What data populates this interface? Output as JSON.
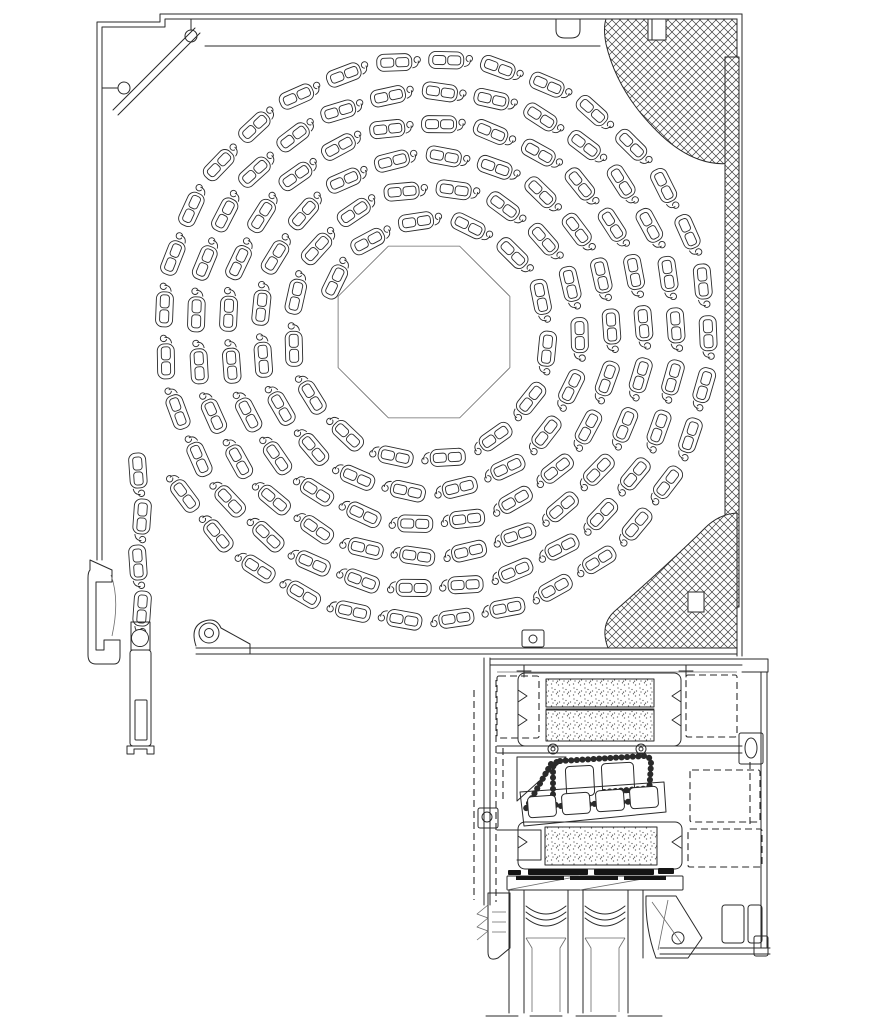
{
  "meta": {
    "drawing_type": "technical-cross-section",
    "subject": "roller-shutter-box-with-coiled-curtain-and-window-frame-profile",
    "visible_text": []
  },
  "colors": {
    "background": "#ffffff",
    "line": "#2a2a2a",
    "line_light": "#6a6a6a",
    "dark": "#151515",
    "hatch": "#3a3a3a",
    "stipple": "#5a5a5a"
  },
  "patterns": {
    "crosshatch": {
      "size": 8,
      "stroke_width": 0.65,
      "paths": [
        "M0,8 L8,0",
        "M0,0 L8,8",
        "M-2,2 L2,-2",
        "M6,10 L10,6",
        "M-2,6 L2,10",
        "M6,-2 L10,2"
      ]
    },
    "stipple": {
      "size": 11,
      "dot_r": 0.65,
      "dots": [
        [
          1.5,
          2
        ],
        [
          5,
          7.5
        ],
        [
          8.5,
          3
        ],
        [
          3,
          10
        ],
        [
          9.5,
          9
        ],
        [
          6.5,
          0.8
        ],
        [
          2,
          6
        ],
        [
          7.5,
          10.2
        ]
      ]
    }
  },
  "layers": [
    {
      "name": "shutter-box",
      "shapes": [
        {
          "t": "p",
          "cls": "ln",
          "d": "M742,14 H160 V22 H97 V560"
        },
        {
          "t": "p",
          "cls": "ln",
          "d": "M737,19 H165 V27 H102 V560"
        },
        {
          "t": "p",
          "cls": "ln",
          "d": "M742,14 V656"
        },
        {
          "t": "p",
          "cls": "ln",
          "d": "M737,19 V656"
        },
        {
          "t": "l",
          "cls": "ln",
          "x1": 196,
          "y1": 648,
          "x2": 737,
          "y2": 648
        },
        {
          "t": "l",
          "cls": "ln",
          "x1": 196,
          "y1": 654,
          "x2": 737,
          "y2": 654
        },
        {
          "t": "p",
          "cls": "ln",
          "d": "M205,46 H600"
        },
        {
          "t": "p",
          "cls": "ln",
          "d": "M113,110 L195,28"
        },
        {
          "t": "p",
          "cls": "ln",
          "d": "M118,115 L200,33"
        },
        {
          "t": "c",
          "cls": "ln",
          "cx": 191,
          "cy": 36,
          "r": 6
        },
        {
          "t": "p",
          "cls": "ln",
          "d": "M191,30 V19"
        },
        {
          "t": "c",
          "cls": "ln",
          "cx": 124,
          "cy": 88,
          "r": 6
        },
        {
          "t": "p",
          "cls": "ln",
          "d": "M118,88 H102"
        },
        {
          "t": "p",
          "cls": "ln",
          "d": "M652,19 V42 H668 V19"
        },
        {
          "t": "p",
          "cls": "ln",
          "d": "M686,19 V56 M691,19 V56"
        },
        {
          "t": "r",
          "cls": "ln",
          "x": 678,
          "y": 56,
          "w": 22,
          "h": 9,
          "rx": 0
        },
        {
          "t": "c",
          "cls": "ln",
          "cx": 712,
          "cy": 41,
          "r": 5
        },
        {
          "t": "c",
          "cls": "ln",
          "cx": 726,
          "cy": 45,
          "r": 4
        },
        {
          "t": "p",
          "cls": "ln",
          "d": "M556,19 v11 q0,8 9,8 h6 q9,0 9,-8 v-11"
        },
        {
          "t": "r",
          "cls": "ln",
          "x": 522,
          "y": 630,
          "w": 22,
          "h": 17,
          "rx": 2
        },
        {
          "t": "c",
          "cls": "ln",
          "cx": 533,
          "cy": 639,
          "r": 4
        },
        {
          "t": "r",
          "cls": "ln",
          "x": 634,
          "y": 630,
          "w": 26,
          "h": 17,
          "rx": 2
        },
        {
          "t": "c",
          "cls": "ln",
          "cx": 647,
          "cy": 639,
          "r": 4
        },
        {
          "t": "p",
          "cls": "ln",
          "d": "M196,646 Q190,628 202,622 Q216,616 221,628 L250,644 V654"
        },
        {
          "t": "c",
          "cls": "ln",
          "cx": 209,
          "cy": 633,
          "r": 10
        },
        {
          "t": "c",
          "cls": "ln",
          "cx": 209,
          "cy": 633,
          "r": 4.5
        }
      ]
    },
    {
      "name": "insulation-blocks",
      "shapes": [
        {
          "t": "hp",
          "d": "M606,19 H648 V40 H666 V19 H737 V162 C712,168 686,158 662,136 C630,106 613,74 606,44 Q603,28 606,19 Z"
        },
        {
          "t": "hp",
          "d": "M725,57 H739 V607 H725 Z"
        },
        {
          "t": "hp",
          "d": "M608,648 Q599,624 616,610 C648,582 686,547 705,528 Q719,514 737,513 L737,648 Z"
        },
        {
          "t": "r",
          "cls": "wn",
          "x": 688,
          "y": 592,
          "w": 16,
          "h": 20,
          "rx": 0
        }
      ]
    },
    {
      "name": "octagonal-shaft",
      "shapes": [
        {
          "t": "oct",
          "cx": 424,
          "cy": 332,
          "r": 93,
          "cls": "thin"
        }
      ]
    },
    {
      "name": "slat-coil",
      "shapes": [
        {
          "t": "coil",
          "cx": 428,
          "cy": 332,
          "rIn": 106,
          "rOut": 294,
          "turns": 5.85,
          "pitch": 52,
          "endDeg": 155
        }
      ]
    },
    {
      "name": "curtain-exit",
      "shapes": [
        {
          "t": "curt",
          "x": 140,
          "yTop": 472,
          "pitch": 46,
          "count": 4
        },
        {
          "t": "p",
          "cls": "ln",
          "d": "M90,560 V570 Q88,572 88,578 V655 Q88,664 96,664 H114 Q120,664 120,656 V640 H104 V650 H96 V582 H112 V570 Z"
        },
        {
          "t": "p",
          "cls": "thin",
          "d": "M111,575 Q120,600 112,636"
        },
        {
          "t": "p",
          "cls": "ln",
          "d": "M131,622 H150 V650 H131 Z"
        },
        {
          "t": "c",
          "cls": "sl",
          "cx": 140,
          "cy": 638,
          "r": 8.5
        },
        {
          "t": "r",
          "cls": "ln",
          "x": 130,
          "y": 650,
          "w": 21,
          "h": 96,
          "rx": 3
        },
        {
          "t": "r",
          "cls": "ln",
          "x": 135,
          "y": 700,
          "w": 12,
          "h": 40,
          "rx": 1
        },
        {
          "t": "p",
          "cls": "ln",
          "d": "M127,746 h27 M127,746 v8 h7 v-5 h13 v5 h7 v-8"
        }
      ]
    },
    {
      "name": "frame-section",
      "shapes": [
        {
          "t": "l",
          "cls": "ln",
          "x1": 490,
          "y1": 659,
          "x2": 742,
          "y2": 659
        },
        {
          "t": "l",
          "cls": "ln",
          "x1": 490,
          "y1": 665,
          "x2": 742,
          "y2": 665
        },
        {
          "t": "l",
          "cls": "thin",
          "x1": 497,
          "y1": 672,
          "x2": 737,
          "y2": 672
        },
        {
          "t": "l",
          "cls": "ln",
          "x1": 484,
          "y1": 658,
          "x2": 484,
          "y2": 905
        },
        {
          "t": "l",
          "cls": "ln",
          "x1": 490,
          "y1": 658,
          "x2": 490,
          "y2": 905
        },
        {
          "t": "r",
          "cls": "dash",
          "x": 497,
          "y": 676,
          "w": 42,
          "h": 62,
          "rx": 2
        },
        {
          "t": "r",
          "cls": "dash",
          "x": 686,
          "y": 675,
          "w": 51,
          "h": 62,
          "rx": 2
        },
        {
          "t": "r",
          "cls": "ln",
          "x": 518,
          "y": 673,
          "w": 163,
          "h": 73,
          "rx": 7
        },
        {
          "t": "p",
          "cls": "ln",
          "d": "M518,690 l9,6 -9,6 M518,714 l9,6 -9,6"
        },
        {
          "t": "p",
          "cls": "ln",
          "d": "M681,690 l-9,6 9,6 M681,714 l-9,6 9,6"
        },
        {
          "t": "sr",
          "x": 546,
          "y": 679,
          "w": 108,
          "h": 28
        },
        {
          "t": "sr",
          "x": 546,
          "y": 710,
          "w": 108,
          "h": 31
        },
        {
          "t": "l",
          "cls": "ln",
          "x1": 546,
          "y1": 709,
          "x2": 654,
          "y2": 709
        },
        {
          "t": "l",
          "cls": "ln",
          "x1": 497,
          "y1": 746,
          "x2": 742,
          "y2": 746
        },
        {
          "t": "l",
          "cls": "ln",
          "x1": 497,
          "y1": 753,
          "x2": 742,
          "y2": 753
        },
        {
          "t": "c",
          "cls": "ln",
          "cx": 553,
          "cy": 749,
          "r": 5
        },
        {
          "t": "c",
          "cls": "ln",
          "cx": 553,
          "cy": 749,
          "r": 2
        },
        {
          "t": "c",
          "cls": "ln",
          "cx": 641,
          "cy": 749,
          "r": 5
        },
        {
          "t": "c",
          "cls": "ln",
          "cx": 641,
          "cy": 749,
          "r": 2
        },
        {
          "t": "r",
          "cls": "ln",
          "x": 739,
          "y": 733,
          "w": 24,
          "h": 31,
          "rx": 2
        },
        {
          "t": "e",
          "cls": "ln",
          "cx": 751,
          "cy": 748,
          "rx": 6,
          "ry": 10
        },
        {
          "t": "p",
          "cls": "ln",
          "d": "M742,659 H768 V672 H742"
        },
        {
          "t": "l",
          "cls": "ln",
          "x1": 761,
          "y1": 672,
          "x2": 761,
          "y2": 948
        },
        {
          "t": "l",
          "cls": "ln",
          "x1": 767,
          "y1": 672,
          "x2": 767,
          "y2": 948
        },
        {
          "t": "p",
          "cls": "ln",
          "d": "M517,757 L566,757 L517,801 Z"
        },
        {
          "t": "p",
          "cls": "dots",
          "d": "M560,761 L644,756 Q651,756 651,764 L649,794 Q649,801 641,801 L560,806 Q553,806 553,798 L553,769 Q553,762 560,761 Z"
        },
        {
          "t": "r",
          "cls": "wn",
          "x": 566,
          "y": 766,
          "w": 28,
          "h": 30,
          "rx": 4,
          "rot": -3
        },
        {
          "t": "r",
          "cls": "wn",
          "x": 602,
          "y": 763,
          "w": 32,
          "h": 30,
          "rx": 4,
          "rot": -3
        },
        {
          "t": "p",
          "cls": "dots",
          "d": "M604,792 L652,788"
        },
        {
          "t": "p",
          "cls": "dots",
          "d": "M551,764 L524,812"
        },
        {
          "t": "p",
          "cls": "ln",
          "d": "M520,792 L664,782 L666,812 L524,826 Z"
        },
        {
          "t": "r",
          "cls": "wn",
          "x": 528,
          "y": 796,
          "w": 28,
          "h": 21,
          "rx": 4,
          "rot": -4
        },
        {
          "t": "r",
          "cls": "wn",
          "x": 562,
          "y": 793,
          "w": 28,
          "h": 21,
          "rx": 4,
          "rot": -4
        },
        {
          "t": "r",
          "cls": "wn",
          "x": 596,
          "y": 790,
          "w": 28,
          "h": 21,
          "rx": 4,
          "rot": -4
        },
        {
          "t": "r",
          "cls": "wn",
          "x": 630,
          "y": 787,
          "w": 28,
          "h": 21,
          "rx": 4,
          "rot": -4
        },
        {
          "t": "r",
          "cls": "ln",
          "x": 518,
          "y": 822,
          "w": 164,
          "h": 47,
          "rx": 7
        },
        {
          "t": "p",
          "cls": "ln",
          "d": "M518,836 l9,6 -9,6 M681,836 l-9,6 9,6"
        },
        {
          "t": "sr",
          "x": 545,
          "y": 827,
          "w": 112,
          "h": 38
        },
        {
          "t": "r",
          "cls": "dash",
          "x": 688,
          "y": 829,
          "w": 74,
          "h": 38,
          "rx": 2
        },
        {
          "t": "r",
          "cls": "gk",
          "x": 528,
          "y": 869,
          "w": 60,
          "h": 6,
          "rx": 1
        },
        {
          "t": "r",
          "cls": "gk",
          "x": 594,
          "y": 869,
          "w": 60,
          "h": 6,
          "rx": 1
        },
        {
          "t": "r",
          "cls": "gk",
          "x": 508,
          "y": 870,
          "w": 13,
          "h": 5,
          "rx": 1
        },
        {
          "t": "r",
          "cls": "gk",
          "x": 658,
          "y": 868,
          "w": 16,
          "h": 6,
          "rx": 1
        },
        {
          "t": "r",
          "cls": "ln",
          "x": 507,
          "y": 876,
          "w": 176,
          "h": 14,
          "rx": 1
        },
        {
          "t": "l",
          "cls": "thin",
          "x1": 507,
          "y1": 890,
          "x2": 580,
          "y2": 876
        },
        {
          "t": "l",
          "cls": "thin",
          "x1": 580,
          "y1": 890,
          "x2": 660,
          "y2": 876
        },
        {
          "t": "r",
          "cls": "gk",
          "x": 516,
          "y": 876,
          "w": 48,
          "h": 4,
          "rx": 0
        },
        {
          "t": "r",
          "cls": "gk",
          "x": 570,
          "y": 876,
          "w": 48,
          "h": 4,
          "rx": 0
        },
        {
          "t": "r",
          "cls": "gk",
          "x": 624,
          "y": 876,
          "w": 42,
          "h": 4,
          "rx": 0
        },
        {
          "t": "p",
          "cls": "ln",
          "d": "M526,906 Q546,922 566,906 M526,912 Q546,928 566,912 M526,918 Q546,934 566,918"
        },
        {
          "t": "p",
          "cls": "ln",
          "d": "M585,906 Q605,922 625,906 M585,912 Q605,928 625,912 M585,918 Q605,934 625,918"
        },
        {
          "t": "l",
          "cls": "ln",
          "x1": 509,
          "y1": 890,
          "x2": 509,
          "y2": 1013
        },
        {
          "t": "l",
          "cls": "ln",
          "x1": 524,
          "y1": 890,
          "x2": 524,
          "y2": 1013
        },
        {
          "t": "l",
          "cls": "ln",
          "x1": 568,
          "y1": 890,
          "x2": 568,
          "y2": 1013
        },
        {
          "t": "l",
          "cls": "ln",
          "x1": 583,
          "y1": 890,
          "x2": 583,
          "y2": 1013
        },
        {
          "t": "l",
          "cls": "ln",
          "x1": 628,
          "y1": 890,
          "x2": 628,
          "y2": 1013
        },
        {
          "t": "l",
          "cls": "ln",
          "x1": 643,
          "y1": 890,
          "x2": 643,
          "y2": 958
        },
        {
          "t": "p",
          "cls": "thin",
          "d": "M526,938 H566 M526,938 L532,948 V1012 M566,938 L560,948 V1012"
        },
        {
          "t": "p",
          "cls": "thin",
          "d": "M585,938 H625 M585,938 L591,948 V1012 M625,938 L619,948 V1012"
        },
        {
          "t": "l",
          "cls": "ln",
          "x1": 486,
          "y1": 1016,
          "x2": 518,
          "y2": 1016
        },
        {
          "t": "l",
          "cls": "ln",
          "x1": 530,
          "y1": 1016,
          "x2": 562,
          "y2": 1016
        },
        {
          "t": "l",
          "cls": "ln",
          "x1": 576,
          "y1": 1016,
          "x2": 616,
          "y2": 1016
        },
        {
          "t": "l",
          "cls": "ln",
          "x1": 628,
          "y1": 1016,
          "x2": 662,
          "y2": 1016
        },
        {
          "t": "p",
          "cls": "ln",
          "d": "M488,893 H510 V948 L498,958 Q488,962 488,952 Z"
        },
        {
          "t": "p",
          "cls": "thin",
          "d": "M488,905 l-11,9 11,4 -11,9 11,4 -11,9"
        },
        {
          "t": "p",
          "cls": "thin",
          "d": "M492,912 h14 M492,922 h14 M492,932 h14"
        },
        {
          "t": "p",
          "cls": "ln",
          "d": "M646,896 L676,896 L702,938 L688,958 L656,958 Q645,928 646,896 Z"
        },
        {
          "t": "c",
          "cls": "ln",
          "cx": 678,
          "cy": 938,
          "r": 6
        },
        {
          "t": "p",
          "cls": "thin",
          "d": "M652,902 L682,944 M668,900 L658,950"
        },
        {
          "t": "l",
          "cls": "ln",
          "x1": 660,
          "y1": 948,
          "x2": 770,
          "y2": 948
        },
        {
          "t": "l",
          "cls": "ln",
          "x1": 660,
          "y1": 954,
          "x2": 770,
          "y2": 954
        },
        {
          "t": "r",
          "cls": "ln",
          "x": 754,
          "y": 936,
          "w": 14,
          "h": 20,
          "rx": 2
        },
        {
          "t": "r",
          "cls": "ln",
          "x": 722,
          "y": 905,
          "w": 22,
          "h": 38,
          "rx": 3
        },
        {
          "t": "r",
          "cls": "ln",
          "x": 748,
          "y": 905,
          "w": 14,
          "h": 38,
          "rx": 3
        },
        {
          "t": "r",
          "cls": "dash",
          "x": 690,
          "y": 770,
          "w": 70,
          "h": 52,
          "rx": 2
        },
        {
          "t": "p",
          "cls": "dash",
          "d": "M750,762 V828"
        },
        {
          "t": "r",
          "cls": "ln",
          "x": 478,
          "y": 808,
          "w": 20,
          "h": 20,
          "rx": 2
        },
        {
          "t": "c",
          "cls": "ln",
          "cx": 487,
          "cy": 817,
          "r": 5
        },
        {
          "t": "p",
          "cls": "ln",
          "d": "M497,830 h44 v30 h-24"
        },
        {
          "t": "p",
          "cls": "dash",
          "d": "M496,680 V902"
        },
        {
          "t": "p",
          "cls": "dash",
          "d": "M503,748 V800"
        },
        {
          "t": "p",
          "cls": "dash",
          "d": "M474,690 V900"
        },
        {
          "t": "p",
          "cls": "ln",
          "d": "M524,665 V677 M517,671 H531"
        },
        {
          "t": "p",
          "cls": "ln",
          "d": "M686,665 V677 M679,671 H693"
        }
      ]
    }
  ]
}
